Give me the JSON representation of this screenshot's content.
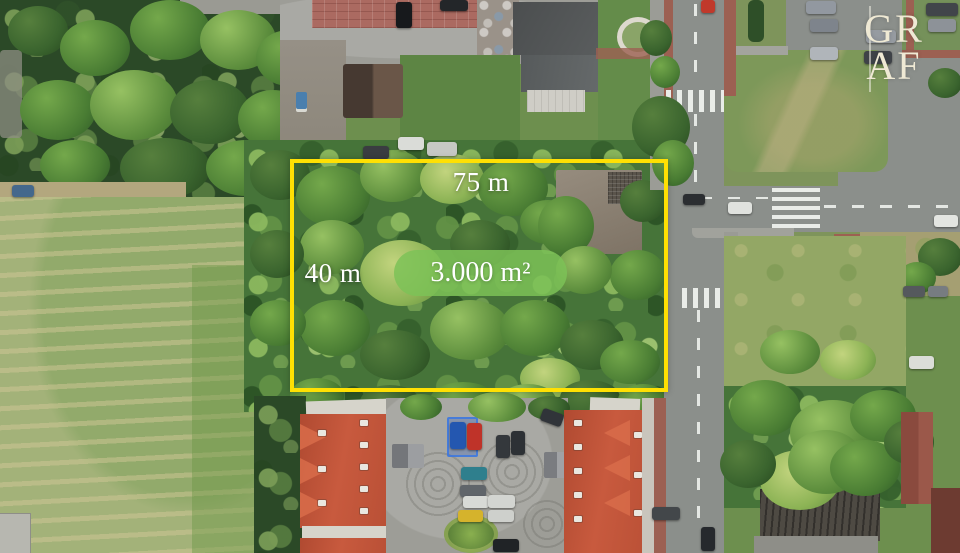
{
  "annotations": {
    "top_dimension": "75 m",
    "side_dimension": "40 m",
    "area_badge": "3.000 m²"
  },
  "branding": {
    "logo_line1": "GR",
    "logo_line2": "AF"
  },
  "colors": {
    "plot_outline": "#ffe003",
    "area_badge_bg": "#7cc257",
    "label_text": "#ffffff",
    "logo_text": "#efe9d4"
  }
}
